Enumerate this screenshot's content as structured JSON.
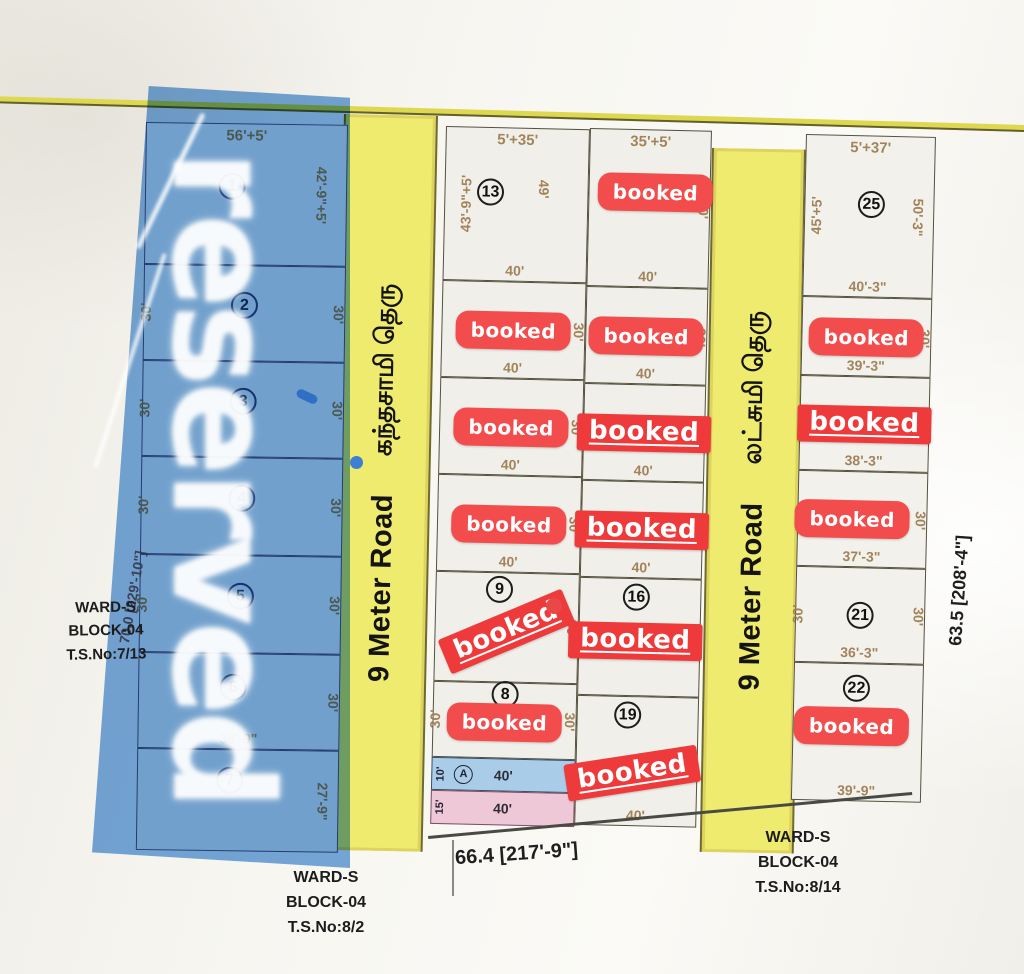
{
  "watermark": {
    "text": "reserved"
  },
  "badge_text": "booked",
  "roads": [
    {
      "name_en": "9 Meter Road",
      "name_ta": "கந்தசாமி தெரு"
    },
    {
      "name_en": "9 Meter Road",
      "name_ta": "லட்சுமி தெரு"
    }
  ],
  "boundaries": {
    "bottom": "66.4 [217'-9\"]",
    "right": "63.5 [208'-4\"]",
    "left": "70.0 [229'-10\"]"
  },
  "ward_labels": {
    "left": {
      "l1": "WARD-S",
      "l2": "BLOCK-04",
      "l3": "T.S.No:7/13"
    },
    "bottom": {
      "l1": "WARD-S",
      "l2": "BLOCK-04",
      "l3": "T.S.No:8/2"
    },
    "right": {
      "l1": "WARD-S",
      "l2": "BLOCK-04",
      "l3": "T.S.No:8/14"
    }
  },
  "columns": {
    "left": [
      {
        "no": "1",
        "dim_top": "56'+5'",
        "dim_right": "42'-9\"+5'"
      },
      {
        "no": "2",
        "dim_left": "30'",
        "dim_right": "30'"
      },
      {
        "no": "3",
        "dim_left": "30'",
        "dim_right": "30'"
      },
      {
        "no": "4",
        "dim_left": "30'",
        "dim_right": "30'"
      },
      {
        "no": "5",
        "dim_left": "30'",
        "dim_right": "30'"
      },
      {
        "no": "6",
        "dim_right": "30'",
        "dim_bottom": "38'-9\""
      },
      {
        "no": "7",
        "dim_right": "27'-9\""
      }
    ],
    "mid_left": [
      {
        "no": "13",
        "dim_top": "5'+35'",
        "dim_left": "43'-9\"+5'",
        "dim_mid": "49'",
        "dim_bottom": "40'"
      },
      {
        "booked": "pill",
        "dim_right": "30'",
        "dim_bottom": "40'"
      },
      {
        "booked": "pill",
        "dim_right": "30'",
        "dim_bottom": "40'"
      },
      {
        "booked": "pill",
        "dim_right": "30'",
        "dim_bottom": "40'"
      },
      {
        "no": "9",
        "booked": "tilt-rect",
        "dim_right": "30'"
      },
      {
        "no": "8",
        "booked": "pill",
        "dim_left": "30'",
        "dim_right": "30'"
      }
    ],
    "mid_left_strips": [
      {
        "label": "A",
        "dim": "40'",
        "edge": "10'"
      },
      {
        "label": "",
        "dim": "40'",
        "edge": "15'"
      }
    ],
    "mid_right": [
      {
        "dim_top": "35'+5'",
        "booked": "pill",
        "dim_bottom": "40'",
        "dim_right": "30'"
      },
      {
        "booked": "pill",
        "dim_bottom": "40'",
        "dim_right": "30'"
      },
      {
        "booked": "rect",
        "dim_bottom": "40'",
        "dim_right": "30'"
      },
      {
        "booked": "rect",
        "dim_bottom": "40'",
        "dim_right": "30'"
      },
      {
        "no": "16",
        "booked": "rect",
        "dim_left": "30'"
      },
      {
        "no": "19",
        "booked": "tilt-rect",
        "dim_bottom": "40'"
      }
    ],
    "right": [
      {
        "no": "25",
        "dim_top": "5'+37'",
        "dim_left": "45'+5'",
        "dim_right": "50'-3\"",
        "dim_bottom": "40'-3\""
      },
      {
        "booked": "pill",
        "dim_right": "30'",
        "dim_bottom": "39'-3\""
      },
      {
        "booked": "rect",
        "dim_bottom": "38'-3\""
      },
      {
        "booked": "pill",
        "dim_right": "30'",
        "dim_bottom": "37'-3\""
      },
      {
        "no": "21",
        "dim_left": "30'",
        "dim_right": "30'",
        "dim_bottom": "36'-3\""
      },
      {
        "no": "22",
        "booked": "pill",
        "dim_bottom": "39'-9\""
      }
    ]
  },
  "colors": {
    "road_yellow": "#efeb6e",
    "reserved_blue": "#5494d8",
    "booked_red": "#ee3a3a",
    "strip_blue": "#a9cde9",
    "strip_pink": "#efc8d7",
    "dim_brown": "#9c7b50"
  }
}
